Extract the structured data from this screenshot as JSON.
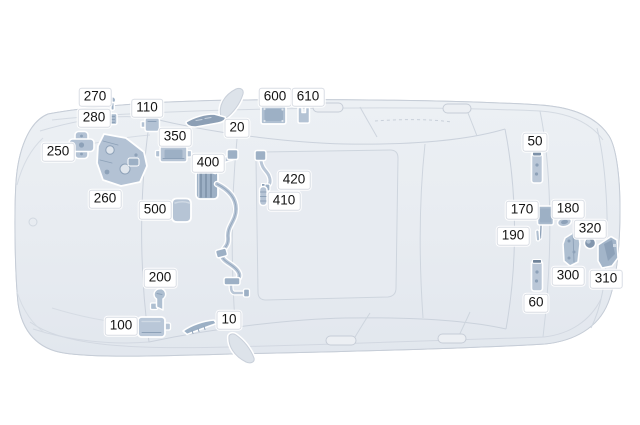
{
  "diagram": {
    "subject": "car-top-view",
    "type": "vehicle-component-location-diagram"
  },
  "palette": {
    "background": "#ffffff",
    "car_body": "#e8ecf1",
    "car_lines": "#ccd3dc",
    "part_fill": "#b6c4d5",
    "part_detail": "#8da1b8",
    "label_bg": "#ffffff",
    "label_text": "#141414"
  },
  "callouts": [
    {
      "label": "10",
      "x": 229,
      "y": 320
    },
    {
      "label": "20",
      "x": 237,
      "y": 128
    },
    {
      "label": "50",
      "x": 535,
      "y": 142
    },
    {
      "label": "60",
      "x": 536,
      "y": 303
    },
    {
      "label": "100",
      "x": 121,
      "y": 326
    },
    {
      "label": "110",
      "x": 147,
      "y": 108
    },
    {
      "label": "170",
      "x": 522,
      "y": 210
    },
    {
      "label": "180",
      "x": 568,
      "y": 209
    },
    {
      "label": "190",
      "x": 513,
      "y": 236
    },
    {
      "label": "200",
      "x": 160,
      "y": 278
    },
    {
      "label": "250",
      "x": 58,
      "y": 152
    },
    {
      "label": "260",
      "x": 105,
      "y": 199
    },
    {
      "label": "270",
      "x": 95,
      "y": 97
    },
    {
      "label": "280",
      "x": 94,
      "y": 118
    },
    {
      "label": "300",
      "x": 568,
      "y": 276
    },
    {
      "label": "310",
      "x": 606,
      "y": 279
    },
    {
      "label": "320",
      "x": 590,
      "y": 229
    },
    {
      "label": "350",
      "x": 175,
      "y": 137
    },
    {
      "label": "400",
      "x": 208,
      "y": 163
    },
    {
      "label": "410",
      "x": 284,
      "y": 201
    },
    {
      "label": "420",
      "x": 294,
      "y": 180
    },
    {
      "label": "500",
      "x": 155,
      "y": 210
    },
    {
      "label": "600",
      "x": 275,
      "y": 97
    },
    {
      "label": "610",
      "x": 308,
      "y": 97
    }
  ]
}
